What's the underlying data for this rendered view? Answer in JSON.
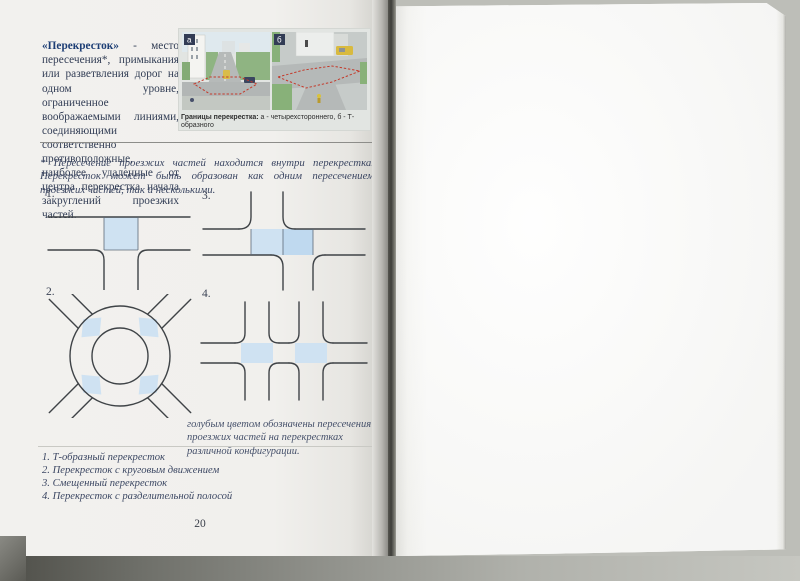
{
  "page": {
    "number": "20",
    "definition": {
      "term": "«Перекресток»",
      "body": " - место пересечения*, примыкания или разветвления дорог на одном уровне, ограниченное воображаемыми линиями, соединяющими соответственно противоположные, наиболее удаленные от центра перекрестка начала закруглений проезжих частей."
    },
    "figure": {
      "label_a": "а",
      "label_b": "б",
      "caption_bold": "Границы перекрестка:",
      "caption_rest": " а - четырехстороннего, б - Т-образного"
    },
    "footnote": "* Пересечение проезжих частей находится внутри перекрестка. Перекресток может быть образован как одним пересечением проезжих частей, так и несколькими.",
    "diagrams": {
      "d1_label": "1.",
      "d2_label": "2.",
      "d3_label": "3.",
      "d4_label": "4.",
      "color_note": "голубым цветом обозначены пересечения проезжих частей на перекрестках различной конфигурации."
    },
    "legend": [
      "1. Т-образный перекресток",
      "2. Перекресток с круговым движением",
      "3. Смещенный перекресток",
      "4. Перекресток с разделительной полосой"
    ],
    "colors": {
      "term_blue": "#1d3e75",
      "intersection_fill": "#cfe2f2",
      "intersection_fill_dark": "#bfd9ef",
      "boundary_red": "#c43a2b",
      "line_dark": "#3f4347"
    }
  }
}
